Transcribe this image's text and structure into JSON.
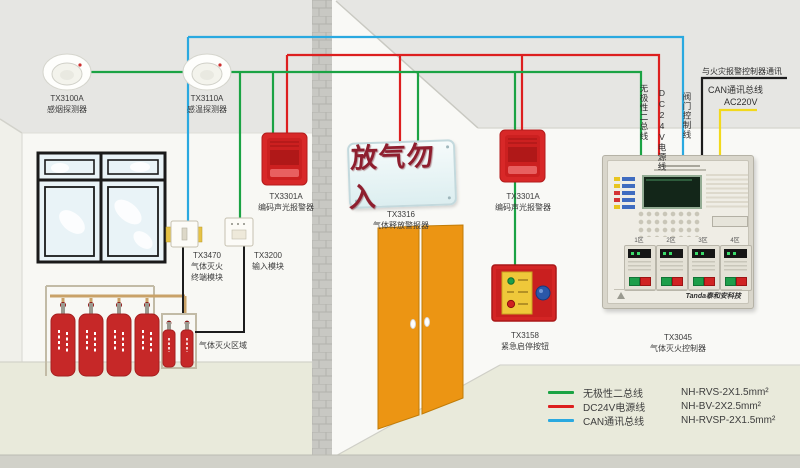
{
  "diagram": {
    "left_room": {
      "detector_smoke": {
        "model": "TX3100A",
        "name": "感烟探测器"
      },
      "detector_heat": {
        "model": "TX3110A",
        "name": "感温探测器"
      },
      "sounder": {
        "model": "TX3301A",
        "name": "编码声光报警器"
      },
      "terminal_module": {
        "model": "TX3470",
        "name_line1": "气体灭火",
        "name_line2": "终端模块"
      },
      "input_module": {
        "model": "TX3200",
        "name": "输入模块"
      },
      "zone_label": "气体灭火区域"
    },
    "right_room": {
      "release_sign_text": "放气勿入",
      "release_alarm": {
        "model": "TX3316",
        "name": "气体释放警报器"
      },
      "sounder": {
        "model": "TX3301A",
        "name": "编码声光报警器"
      },
      "emergency_button": {
        "model": "TX3158",
        "name": "紧急启停按钮"
      },
      "controller": {
        "model": "TX3045",
        "name": "气体灭火控制器",
        "brand": "Tanda泰和安科技",
        "zone_labels": [
          "1区",
          "2区",
          "3区",
          "4区"
        ]
      }
    },
    "riser_labels": {
      "bus": "无极性二总线",
      "power": "DC24V电源线",
      "valve": "阀门控制线",
      "can_note": "与火灾报警控制器通讯",
      "can": "CAN通讯总线",
      "ac": "AC220V"
    },
    "legend": {
      "items": [
        {
          "label": "无极性二总线",
          "spec": "NH-RVS-2X1.5mm²",
          "color": "#1ba344"
        },
        {
          "label": "DC24V电源线",
          "spec": "NH-BV-2X2.5mm²",
          "color": "#dd1f1f"
        },
        {
          "label": "CAN通讯总线",
          "spec": "NH-RVSP-2X1.5mm²",
          "color": "#2aa9e0"
        }
      ]
    },
    "colors": {
      "bus_line": "#1ba344",
      "power_line": "#dd1f1f",
      "can_line": "#2aa9e0",
      "device_line": "#1c1c1c",
      "ac_line": "#f2d91c",
      "door": "#ec9513",
      "alarm_red": "#d82828"
    }
  }
}
